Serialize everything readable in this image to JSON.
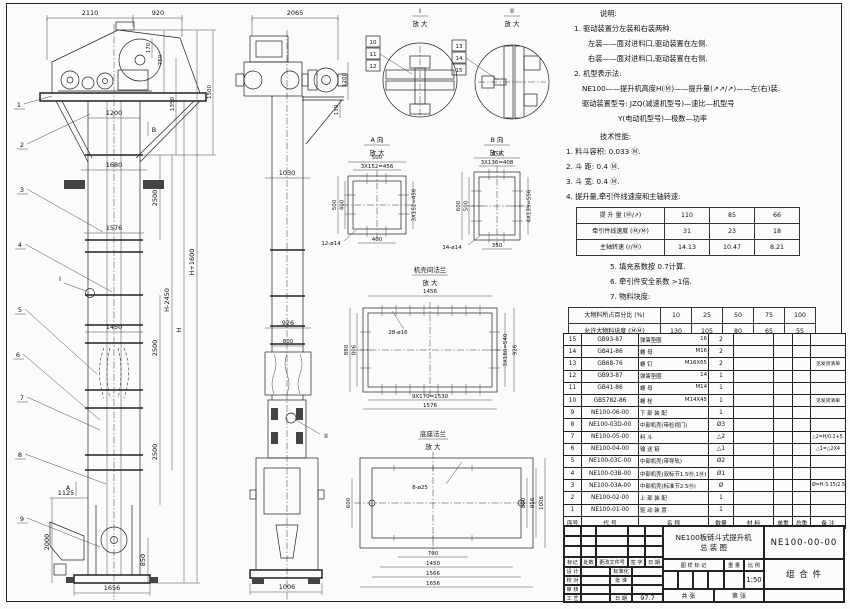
{
  "notes": {
    "title": "说明:",
    "l0": "1. 驱动装置分左装和右装两种.",
    "l1": "左装——面对进料口,驱动装置在左侧.",
    "l2": "右装——面对进料口,驱动装置在右侧.",
    "l3": "2. 机型表示法:",
    "l4": "NE100——提升机高度H(Ⓜ)——提升量(↗↗/↗)——左(右)装.",
    "l5": "驱动装置型号: JZQ(减速机型号)—速比—机型号",
    "l6": "Y(电动机型号)—极数—功率"
  },
  "tech": {
    "title": "技术性能:",
    "t0": "1. 料斗容积: 0.033 Ⓜ.",
    "t1": "2. 斗  距: 0.4 Ⓜ.",
    "t2": "3. 斗  宽: 0.4 Ⓜ.",
    "t3": "4. 提升量,牵引件线速度和主轴转速:",
    "t4": "5. 填充系数按 0.7计算.",
    "t5": "6. 牵引件安全系数 >1倍.",
    "t6": "7. 物料块度:"
  },
  "speed_table": {
    "rows": [
      [
        "提 升 量  (Ⓜ/↗)",
        "110",
        "85",
        "66"
      ],
      [
        "牵引件线速度 (Ⓜ/Ⓜ)",
        "31",
        "23",
        "18"
      ],
      [
        "主轴转速 (r/Ⓜ)",
        "14.13",
        "10.47",
        "8.21"
      ]
    ]
  },
  "lump_table": {
    "rows": [
      [
        "大物料所占百分比 (%)",
        "10",
        "25",
        "50",
        "75",
        "100"
      ],
      [
        "允许大物料块度 (ⓂⓂ)",
        "130",
        "105",
        "80",
        "65",
        "55"
      ]
    ]
  },
  "bom": {
    "headers": [
      "序号",
      "代    号",
      "名    称",
      "数量",
      "材    料",
      "单重",
      "总重",
      "备  注"
    ],
    "rows": [
      [
        "15",
        "GB93-87",
        "弹簧垫圈",
        "16",
        "2",
        "",
        "",
        "",
        ""
      ],
      [
        "14",
        "GB41-86",
        "螺  母",
        "M16",
        "2",
        "",
        "",
        "",
        ""
      ],
      [
        "13",
        "GB68-76",
        "螺  钉",
        "M16X65",
        "2",
        "",
        "",
        "",
        "见发货清单"
      ],
      [
        "12",
        "GB93-87",
        "弹簧垫圈",
        "14",
        "1",
        "",
        "",
        "",
        ""
      ],
      [
        "11",
        "GB41-86",
        "螺  母",
        "M14",
        "1",
        "",
        "",
        "",
        ""
      ],
      [
        "10",
        "GB5782-86",
        "螺  栓",
        "M14X45",
        "1",
        "",
        "",
        "",
        "见发货清单"
      ],
      [
        "9",
        "NE100-06-00",
        "下 部 装 配",
        "",
        "1",
        "",
        "",
        "",
        ""
      ],
      [
        "8",
        "NE100-03D-00",
        "中部机壳(带检视门)",
        "",
        "Ø3",
        "",
        "",
        "",
        ""
      ],
      [
        "7",
        "NE100-05-00",
        "料  斗",
        "",
        "△2",
        "",
        "",
        "",
        "△2=H/0.2+5.75"
      ],
      [
        "6",
        "NE100-04-00",
        "输 送 链",
        "",
        "△1",
        "",
        "",
        "",
        "△1=△2X4"
      ],
      [
        "5",
        "NE100-03C-00",
        "中部机壳(带导轨)",
        "",
        "Ø2",
        "",
        "",
        "",
        ""
      ],
      [
        "4",
        "NE100-03B-00",
        "中部机壳(双标节1.5Ⓜ,1Ⓜ)",
        "",
        "Ø1",
        "",
        "",
        "",
        ""
      ],
      [
        "3",
        "NE100-03A-00",
        "中部机壳(标准节2.5Ⓜ)",
        "",
        "Ø",
        "",
        "",
        "",
        "Ø=H-3.15/2.5"
      ],
      [
        "2",
        "NE100-02-00",
        "上 部 装 配",
        "",
        "1",
        "",
        "",
        "",
        ""
      ],
      [
        "1",
        "NE100-01-00",
        "驱 动 装 置",
        "",
        "1",
        "",
        "",
        "",
        ""
      ]
    ]
  },
  "title_block": {
    "product_line1": "NE100板链斗式提升机",
    "product_line2": "总  装  图",
    "drawing_no": "NE100-00-00",
    "category": "组 合 件",
    "rev_cols": [
      "标记",
      "处数",
      "更改文件号",
      "签 字",
      "日 期"
    ],
    "sign_left": [
      "设 计",
      "校 对",
      "审 核",
      "工 艺"
    ],
    "sign_right": [
      "标准化",
      "批 准",
      "",
      "日 期"
    ],
    "date": "97.7",
    "stamp_header": [
      "图 样 标 记",
      "重 量",
      "比 例"
    ],
    "scale": "1:50",
    "sheet_left": "共  张",
    "sheet_right": "第  张"
  },
  "left_view": {
    "d2110": "2110",
    "d920": "920",
    "d170": "170",
    "d750": "750",
    "d1350": "1350",
    "d1500": "1500",
    "d1200": "1200",
    "d1680": "1680",
    "d1576": "1576",
    "d1450": "1450",
    "d1125": "1125",
    "d2000": "2000",
    "d850": "850",
    "d1656": "1656",
    "d2500a": "2500",
    "d2500b": "2500",
    "d2500c": "2500",
    "dHp": "H+1600",
    "dHm": "H-2450",
    "dH": "H",
    "balloons": [
      "1",
      "2",
      "3",
      "4",
      "5",
      "6",
      "7",
      "8",
      "9"
    ],
    "mA": "A",
    "mB": "B",
    "mI": "I"
  },
  "middle_view": {
    "d2065": "2065",
    "d1200": "1200",
    "d130": "130",
    "d1030": "1030",
    "d926": "926",
    "d800": "800",
    "d1006": "1006",
    "mII": "II"
  },
  "detail_i": {
    "title": "I",
    "sub": "放 大",
    "balloons": [
      "10",
      "11",
      "12"
    ]
  },
  "detail_ii": {
    "title": "II",
    "sub": "放 大",
    "balloons": [
      "13",
      "14",
      "15"
    ]
  },
  "detail_a": {
    "title": "A 向",
    "sub": "放 大",
    "d500t": "500",
    "d456t": "3X152=456",
    "d500l": "500",
    "d400l": "400",
    "d400b": "400",
    "holes": "12-ø14",
    "d456r": "3X152=456"
  },
  "detail_b": {
    "title": "B 向",
    "sub": "放 大",
    "d450": "450",
    "d408": "3X136=408",
    "d600": "600",
    "d500": "500",
    "d350": "350",
    "holes": "14-ø14",
    "d556": "4X139=556"
  },
  "detail_fl": {
    "title": "机壳间法兰",
    "sub": "放 大",
    "d1456": "1456",
    "holes": "28-ø16",
    "d880": "880",
    "d806": "806",
    "d540": "3X180=540",
    "d926": "926",
    "d1530": "9X170=1530",
    "d1576": "1576"
  },
  "detail_bs": {
    "title": "底座法兰",
    "sub": "放 大",
    "holes": "8-ø25",
    "d600": "600",
    "d800": "800",
    "d916": "916",
    "d1006": "1006",
    "d700": "700",
    "d1450": "1450",
    "d1566": "1566",
    "d1656": "1656"
  },
  "colors": {
    "line": "#222222",
    "paper": "#fbfbf9"
  }
}
